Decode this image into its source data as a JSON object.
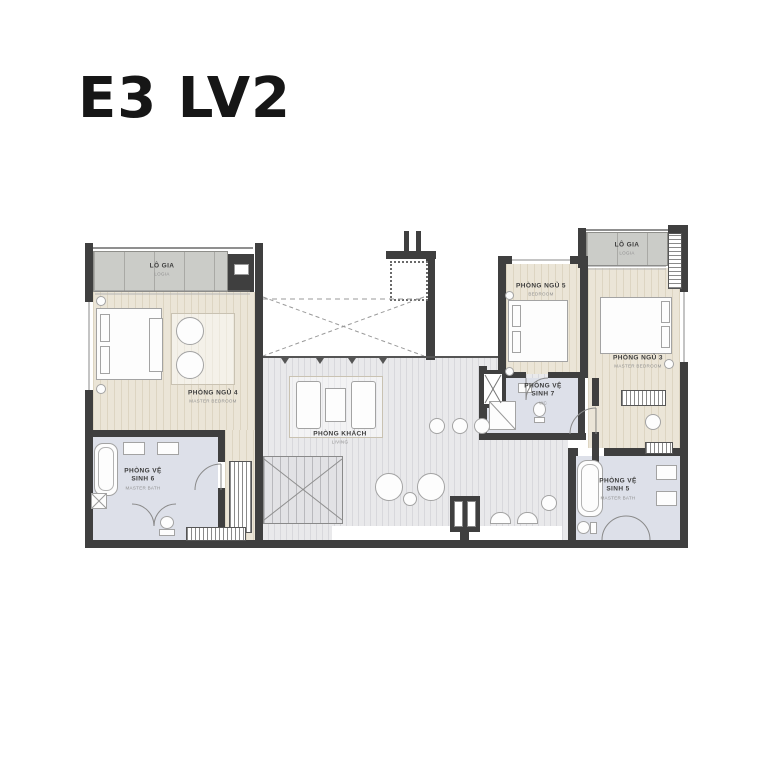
{
  "title": "E3 LV2",
  "colors": {
    "wall": "#3f3f3f",
    "bedroom_floor": "#ebe5d7",
    "living_floor": "#e9e9eb",
    "bath_floor": "#dde0e9",
    "loggia_floor": "#cbccc8",
    "label_text": "#3c3c3c",
    "title_text": "#161616"
  },
  "rooms": [
    {
      "id": "logia-left",
      "name": "LÔ GIA",
      "sub": "LOGIA"
    },
    {
      "id": "bedroom-4",
      "name": "PHÒNG NGỦ 4",
      "sub": "MASTER BEDROOM"
    },
    {
      "id": "bath-6",
      "name": "PHÒNG VỆ SINH 6",
      "sub": "MASTER BATH"
    },
    {
      "id": "living",
      "name": "PHÒNG KHÁCH",
      "sub": "LIVING"
    },
    {
      "id": "bedroom-5",
      "name": "PHÒNG NGỦ 5",
      "sub": "BEDROOM"
    },
    {
      "id": "wc-7",
      "name": "PHÒNG VỆ SINH 7",
      "sub": "WC"
    },
    {
      "id": "bedroom-3",
      "name": "PHÒNG NGỦ 3",
      "sub": "MASTER BEDROOM"
    },
    {
      "id": "logia-right",
      "name": "LÔ GIA",
      "sub": "LOGIA"
    },
    {
      "id": "bath-5",
      "name": "PHÒNG VỆ SINH 5",
      "sub": "MASTER BATH"
    }
  ]
}
